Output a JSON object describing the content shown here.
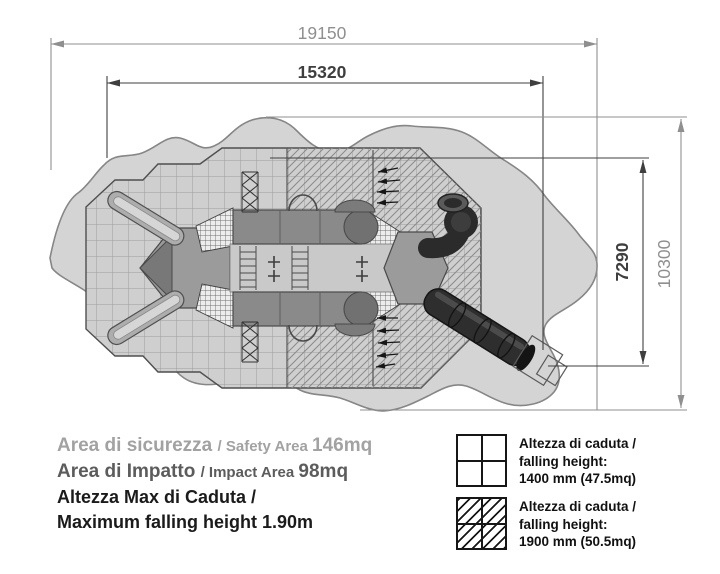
{
  "drawing": {
    "title": "playground safety area plan",
    "dimensions": {
      "total_width_mm": "19150",
      "impact_width_mm": "15320",
      "impact_height_mm": "7290",
      "total_height_mm": "10300"
    },
    "colors": {
      "background": "#ffffff",
      "safety_blob_fill": "#d4d4d4",
      "safety_blob_stroke": "#868686",
      "impact_area_fill": "#cfcfcf",
      "grid_line": "#9c9c9c",
      "hatch_line": "#8f8f8f",
      "structure_gray": "#8a8a8a",
      "dark_equipment": "#2b2b2b",
      "dim_gray": "#8f8f8f",
      "dim_dark": "#3f3f3f"
    }
  },
  "area_info": {
    "safety": {
      "label_it": "Area di sicurezza",
      "label_en": "/ Safety Area ",
      "value": "146mq"
    },
    "impact": {
      "label_it": "Area di Impatto",
      "label_en": "/ Impact Area ",
      "value": "98mq"
    },
    "max_fall_line1": "Altezza Max di Caduta /",
    "max_fall_line2": "Maximum falling height 1.90m"
  },
  "legend": {
    "items": [
      {
        "swatch": "grid-swatch",
        "line1": "Altezza di caduta /",
        "line2": "falling height:",
        "line3": "1400 mm (47.5mq)"
      },
      {
        "swatch": "hatch-swatch",
        "line1": "Altezza di caduta /",
        "line2": "falling height:",
        "line3": "1900 mm (50.5mq)"
      }
    ]
  }
}
